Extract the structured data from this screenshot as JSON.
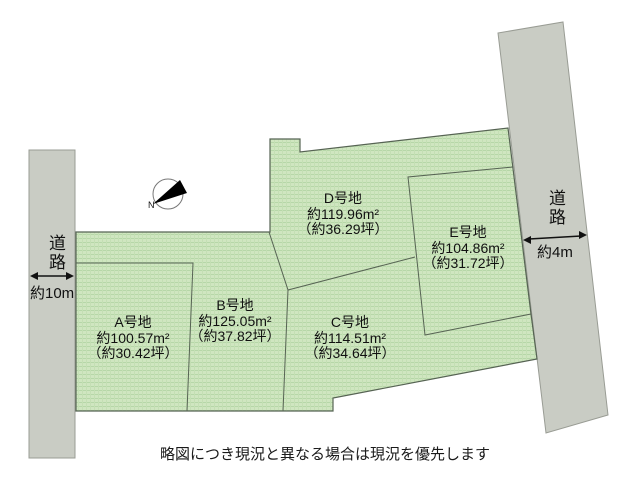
{
  "diagram": {
    "compass_label": "N",
    "disclaimer": "略図につき現況と異なる場合は現況を優先します",
    "roads": {
      "left": {
        "label": "道路",
        "width_label": "約10m"
      },
      "right": {
        "label": "道路",
        "width_label": "約4m"
      }
    },
    "lots": [
      {
        "id": "A",
        "name": "A号地",
        "area_sqm": "約100.57m²",
        "area_tsubo": "（約30.42坪）"
      },
      {
        "id": "B",
        "name": "B号地",
        "area_sqm": "約125.05m²",
        "area_tsubo": "（約37.82坪）"
      },
      {
        "id": "C",
        "name": "C号地",
        "area_sqm": "約114.51m²",
        "area_tsubo": "（約34.64坪）"
      },
      {
        "id": "D",
        "name": "D号地",
        "area_sqm": "約119.96m²",
        "area_tsubo": "（約36.29坪）"
      },
      {
        "id": "E",
        "name": "E号地",
        "area_sqm": "約104.86m²",
        "area_tsubo": "（約31.72坪）"
      }
    ],
    "colors": {
      "land_green": "#cfe6c0",
      "land_hatch": "#b6d7a8",
      "road_gray": "#c9ccc4",
      "outline": "#566353"
    }
  }
}
